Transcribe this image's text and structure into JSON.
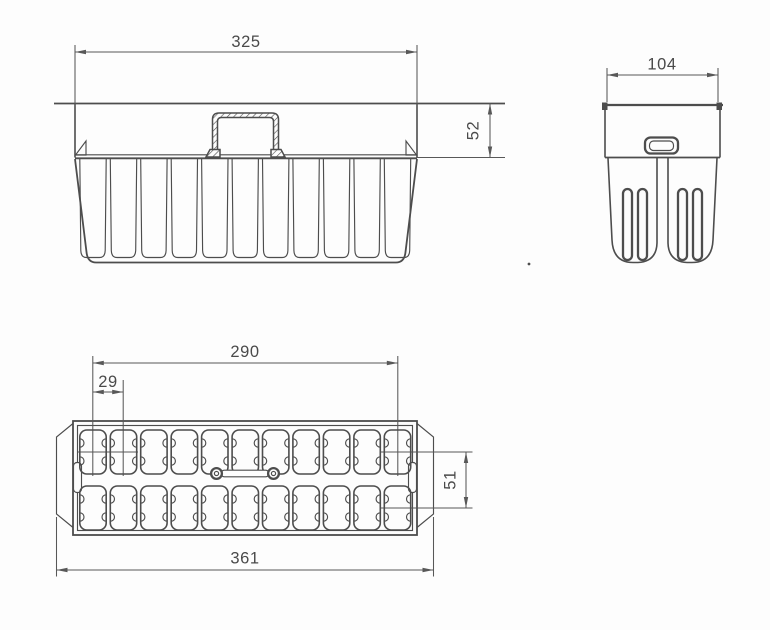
{
  "drawing": {
    "background_color": "#fdfdfd",
    "line_color": "#4d4d4d",
    "dimension_color": "#585858",
    "views": {
      "front": {
        "dims": {
          "width": "325",
          "height": "52"
        }
      },
      "side": {
        "dims": {
          "width": "104"
        }
      },
      "plan": {
        "dims": {
          "cavity_span": "290",
          "cavity_pitch": "29",
          "row_spacing": "51",
          "overall_length": "361"
        }
      }
    },
    "structure": {
      "plan_columns": 11,
      "plan_rows": 2,
      "front_fingers": 11,
      "side_slot_centers": [
        627.5,
        642.5,
        682.5,
        697.5
      ]
    }
  }
}
